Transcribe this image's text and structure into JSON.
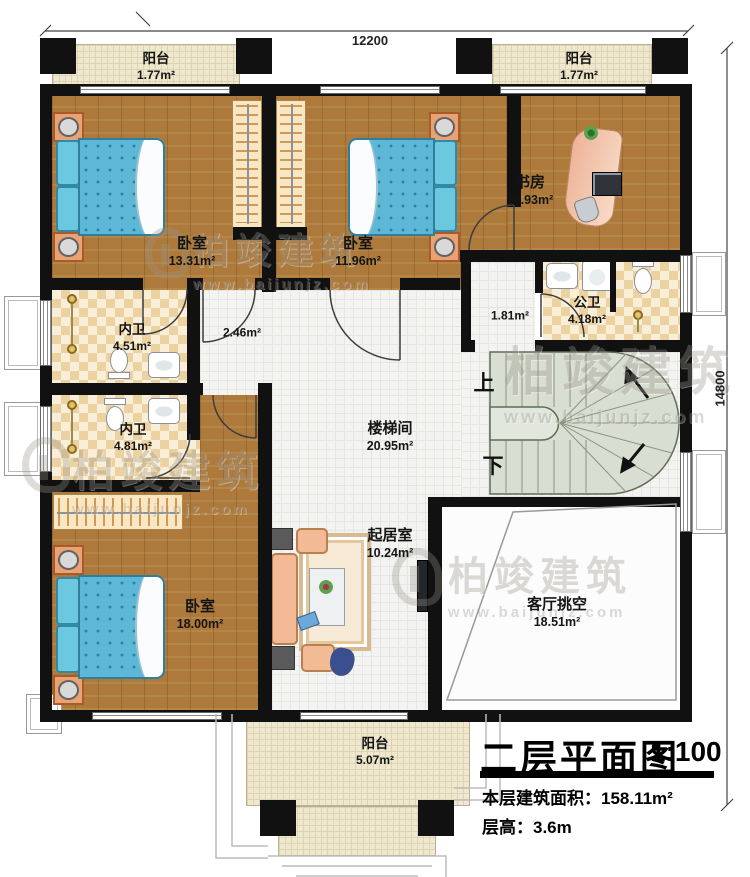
{
  "title_block": {
    "title": "二层平面图",
    "scale": "1:100",
    "area_label": "本层建筑面积：",
    "area_value": "158.11m²",
    "floor_height_label": "层高：",
    "floor_height_value": "3.6m"
  },
  "dimensions": {
    "top": "12200",
    "right": "14800"
  },
  "stairs": {
    "up_label": "上",
    "down_label": "下"
  },
  "watermark": {
    "brand": "柏竣建筑",
    "url": "www.baijunjz.com"
  },
  "rooms": {
    "balcony_top_left": {
      "name": "阳台",
      "area": "1.77m²"
    },
    "balcony_top_right": {
      "name": "阳台",
      "area": "1.77m²"
    },
    "bedroom_top_left": {
      "name": "卧室",
      "area": "13.31m²"
    },
    "bedroom_top_mid": {
      "name": "卧室",
      "area": "11.96m²"
    },
    "study": {
      "name": "书房",
      "area": "10.93m²"
    },
    "hall_small": {
      "area": "1.81m²"
    },
    "public_bath": {
      "name": "公卫",
      "area": "4.18m²"
    },
    "ensuite_upper": {
      "name": "内卫",
      "area": "4.51m²"
    },
    "corridor": {
      "area": "2.46m²"
    },
    "ensuite_lower": {
      "name": "内卫",
      "area": "4.81m²"
    },
    "stair_hall": {
      "name": "楼梯间",
      "area": "20.95m²"
    },
    "family_room": {
      "name": "起居室",
      "area": "10.24m²"
    },
    "bedroom_large": {
      "name": "卧室",
      "area": "18.00m²"
    },
    "living_void": {
      "name": "客厅挑空",
      "area": "18.51m²"
    },
    "balcony_bottom": {
      "name": "阳台",
      "area": "5.07m²"
    }
  }
}
